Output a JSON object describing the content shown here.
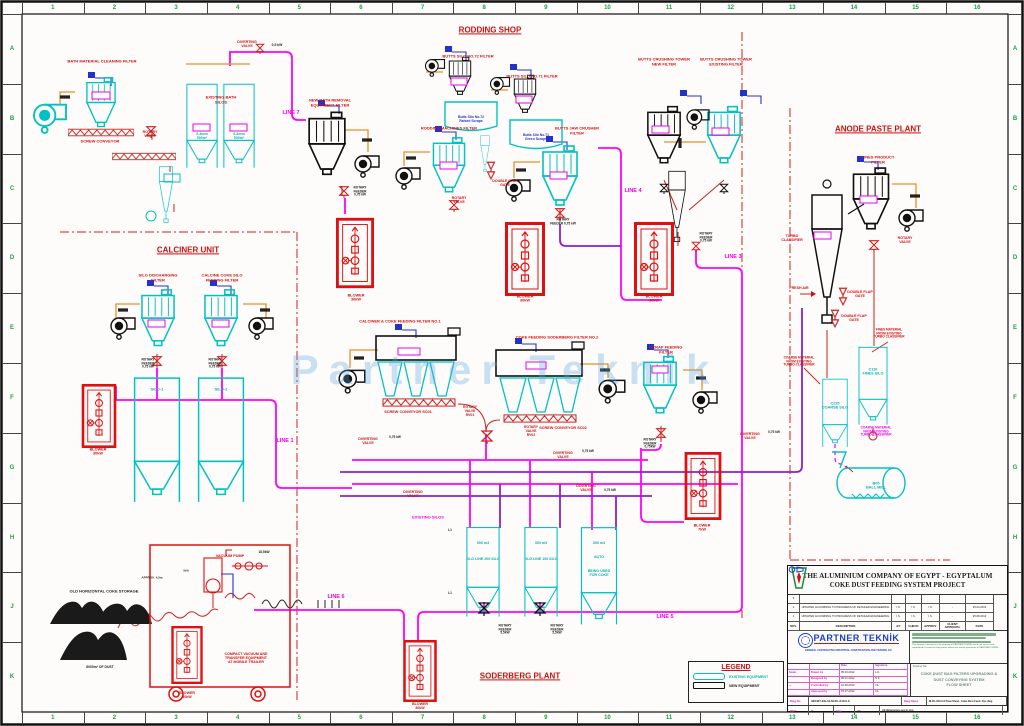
{
  "colors": {
    "red": "#cc1111",
    "magenta": "#ee00ee",
    "purple": "#8822cc",
    "cyan": "#00b2b2",
    "black": "#222222",
    "green": "#18a04a",
    "blue": "#2233cc",
    "existing": "#00c2c2",
    "new": "#111111",
    "pipe_magenta": "#ff00ff"
  },
  "watermark": "Partner Teknik",
  "grid": {
    "cols": [
      "1",
      "2",
      "3",
      "4",
      "5",
      "6",
      "7",
      "8",
      "9",
      "10",
      "11",
      "12",
      "13",
      "14",
      "15",
      "16"
    ],
    "rows": [
      "A",
      "B",
      "C",
      "D",
      "E",
      "F",
      "G",
      "H",
      "J",
      "K"
    ]
  },
  "legend": {
    "title": "LEGEND",
    "items": [
      {
        "label": "EXISTING EQUIPMENT",
        "cls": "existing"
      },
      {
        "label": "NEW EQUIPMENT",
        "cls": "new"
      }
    ]
  },
  "labels": [
    {
      "t": "RODDING SHOP",
      "x": 490,
      "y": 30,
      "c": "red",
      "f": 8,
      "u": 1
    },
    {
      "t": "ANODE PASTE PLANT",
      "x": 878,
      "y": 129,
      "c": "red",
      "f": 8,
      "u": 1
    },
    {
      "t": "CALCINER UNIT",
      "x": 188,
      "y": 250,
      "c": "red",
      "f": 8,
      "u": 1
    },
    {
      "t": "SODERBERG PLANT",
      "x": 520,
      "y": 676,
      "c": "red",
      "f": 8,
      "u": 1
    },
    {
      "t": "BATH MATERIAL CLEANING FILTER",
      "x": 102,
      "y": 62,
      "c": "red",
      "f": 4
    },
    {
      "t": "SCREW CONVEYOR",
      "x": 100,
      "y": 142,
      "c": "red",
      "f": 4
    },
    {
      "t": "ROTARY\nVALVE",
      "x": 150,
      "y": 134,
      "c": "red",
      "f": 3.6
    },
    {
      "t": "EXISTING BATH\nSILOS",
      "x": 221,
      "y": 100,
      "c": "red",
      "f": 4
    },
    {
      "t": "0-4mm\n500m³",
      "x": 202,
      "y": 136,
      "c": "cyan",
      "f": 3.6
    },
    {
      "t": "0-4mm\n500m³",
      "x": 239,
      "y": 136,
      "c": "cyan",
      "f": 3.6
    },
    {
      "t": "DIVERTING\nVALVE",
      "x": 247,
      "y": 44,
      "c": "red",
      "f": 3.6
    },
    {
      "t": "0,5 kW",
      "x": 277,
      "y": 46,
      "c": "black",
      "f": 3.4
    },
    {
      "t": "LINE 7",
      "x": 291,
      "y": 113,
      "c": "magenta",
      "f": 5.5
    },
    {
      "t": "NEW BATH REMOVAL\nEQUIPMENT FILTER",
      "x": 330,
      "y": 103,
      "c": "red",
      "f": 4
    },
    {
      "t": "ROTARY\nFEEDER\n0,75 kW",
      "x": 360,
      "y": 192,
      "c": "black",
      "f": 3.2
    },
    {
      "t": "BLOWER\n30kW",
      "x": 356,
      "y": 298,
      "c": "red",
      "f": 3.8
    },
    {
      "t": "BUTTS SILO NO.72 FILTER",
      "x": 468,
      "y": 57,
      "c": "red",
      "f": 4
    },
    {
      "t": "Butts Silo No.72\nRaised Scraps",
      "x": 471,
      "y": 120,
      "c": "blue",
      "f": 3.4
    },
    {
      "t": "BUTTS SILO NO.71 FILTER",
      "x": 532,
      "y": 77,
      "c": "red",
      "f": 4
    },
    {
      "t": "Butts Silo No.71\nGreen Scraps",
      "x": 536,
      "y": 138,
      "c": "blue",
      "f": 3.4
    },
    {
      "t": "RODDING MACHINES FILTER",
      "x": 449,
      "y": 129,
      "c": "red",
      "f": 4
    },
    {
      "t": "ROTARY\nVALVE",
      "x": 459,
      "y": 200,
      "c": "red",
      "f": 3.6
    },
    {
      "t": "DOUBLE FLAP\nGATE",
      "x": 505,
      "y": 183,
      "c": "red",
      "f": 3.6
    },
    {
      "t": "BUTTS JAW CRUSHER\nFILTER",
      "x": 577,
      "y": 131,
      "c": "red",
      "f": 4
    },
    {
      "t": "ROTARY\nFEEDER 0,75 kW",
      "x": 563,
      "y": 222,
      "c": "black",
      "f": 3.2
    },
    {
      "t": "BLOWER\n30kW",
      "x": 525,
      "y": 299,
      "c": "red",
      "f": 3.8
    },
    {
      "t": "BLOWER\n30kW",
      "x": 654,
      "y": 299,
      "c": "red",
      "f": 3.8
    },
    {
      "t": "BUTTS CRUSHING TOWER\nNEW FILTER",
      "x": 664,
      "y": 62,
      "c": "red",
      "f": 4
    },
    {
      "t": "BUTTS CRUSHING TOWER\nEXISTING FILTER",
      "x": 726,
      "y": 62,
      "c": "red",
      "f": 4
    },
    {
      "t": "ROTARY\nFEEDER\n0,75 kW",
      "x": 706,
      "y": 238,
      "c": "black",
      "f": 3.2
    },
    {
      "t": "LINE 4",
      "x": 633,
      "y": 191,
      "c": "magenta",
      "f": 5.5
    },
    {
      "t": "LINE 3",
      "x": 733,
      "y": 257,
      "c": "magenta",
      "f": 5.5
    },
    {
      "t": "FINES PRODUCT\nFILTER",
      "x": 878,
      "y": 160,
      "c": "red",
      "f": 4
    },
    {
      "t": "ROTARY\nVALVE",
      "x": 905,
      "y": 240,
      "c": "red",
      "f": 3.6
    },
    {
      "t": "TURBO\nCLASSIFIER",
      "x": 792,
      "y": 238,
      "c": "red",
      "f": 3.6
    },
    {
      "t": "FRESH AIR",
      "x": 799,
      "y": 288,
      "c": "red",
      "f": 3.6
    },
    {
      "t": "DOUBLE FLAP\nGATE",
      "x": 860,
      "y": 294,
      "c": "red",
      "f": 3.6
    },
    {
      "t": "DOUBLE FLAP\nGATE",
      "x": 854,
      "y": 318,
      "c": "red",
      "f": 3.6
    },
    {
      "t": "FINES MATERIAL\nFROM EXISTING\nTURBO CLASSIFIER",
      "x": 889,
      "y": 334,
      "c": "red",
      "f": 3.2
    },
    {
      "t": "COARSE MATERIAL\nFROM EXISTING\nTURBO CLASSIFIER",
      "x": 799,
      "y": 362,
      "c": "red",
      "f": 3.2
    },
    {
      "t": "C110\nFINES SILO",
      "x": 873,
      "y": 372,
      "c": "cyan",
      "f": 3.8
    },
    {
      "t": "C225\nCOARSE SILO",
      "x": 835,
      "y": 406,
      "c": "cyan",
      "f": 3.8
    },
    {
      "t": "COARSE MATERIAL\nFROM EXISTING\nTURBO CLASSIFIER",
      "x": 876,
      "y": 432,
      "c": "magenta",
      "f": 3.2
    },
    {
      "t": "B05\nBALL MILL",
      "x": 876,
      "y": 486,
      "c": "cyan",
      "f": 3.8
    },
    {
      "t": "SILO DISCHARGING\nFILTER",
      "x": 158,
      "y": 278,
      "c": "red",
      "f": 4
    },
    {
      "t": "CALCINE COKE SILO\nFEEDING FILTER",
      "x": 222,
      "y": 278,
      "c": "red",
      "f": 4
    },
    {
      "t": "ROTARY\nFEEDER\n0,75 kW",
      "x": 148,
      "y": 364,
      "c": "black",
      "f": 3.2
    },
    {
      "t": "ROTARY\nFEEDER\n0,75 kW",
      "x": 215,
      "y": 364,
      "c": "black",
      "f": 3.2
    },
    {
      "t": "BLOWER\n30kW",
      "x": 98,
      "y": 452,
      "c": "red",
      "f": 3.8
    },
    {
      "t": "SILO-1",
      "x": 157,
      "y": 390,
      "c": "cyan",
      "f": 4
    },
    {
      "t": "SILO-2",
      "x": 221,
      "y": 390,
      "c": "cyan",
      "f": 4
    },
    {
      "t": "LINE 1",
      "x": 285,
      "y": 441,
      "c": "magenta",
      "f": 5.5
    },
    {
      "t": "CALCINER & COKE FEEDING  FILTER NO.1",
      "x": 400,
      "y": 322,
      "c": "red",
      "f": 4
    },
    {
      "t": "COKE FEEDING SODERBERG FILTER NO.2",
      "x": 557,
      "y": 338,
      "c": "red",
      "f": 4
    },
    {
      "t": "SCREW CONVEYOR SC01",
      "x": 408,
      "y": 412,
      "c": "red",
      "f": 3.8
    },
    {
      "t": "ROTARY\nVALVE\nRV01",
      "x": 470,
      "y": 412,
      "c": "red",
      "f": 3.4
    },
    {
      "t": "SCREW CONVEYOR SC02",
      "x": 563,
      "y": 428,
      "c": "red",
      "f": 3.8
    },
    {
      "t": "ROTARY\nVALVE\nRV02",
      "x": 531,
      "y": 432,
      "c": "red",
      "f": 3.4
    },
    {
      "t": "SCRAP FEEDING\nFILTER",
      "x": 666,
      "y": 350,
      "c": "red",
      "f": 4
    },
    {
      "t": "ROTARY\nFEEDER\n0,75kW",
      "x": 650,
      "y": 444,
      "c": "black",
      "f": 3.2
    },
    {
      "t": "BLOWER\n7kW",
      "x": 702,
      "y": 528,
      "c": "red",
      "f": 3.8
    },
    {
      "t": "DIVERTING\nVALVE",
      "x": 368,
      "y": 441,
      "c": "red",
      "f": 3.6
    },
    {
      "t": "0,75 kW",
      "x": 395,
      "y": 438,
      "c": "black",
      "f": 3.2
    },
    {
      "t": "DIVERTING\nVALVE",
      "x": 413,
      "y": 494,
      "c": "red",
      "f": 3.6
    },
    {
      "t": "DIVERTING\nVALVE",
      "x": 563,
      "y": 455,
      "c": "red",
      "f": 3.6
    },
    {
      "t": "0,75 kW",
      "x": 588,
      "y": 452,
      "c": "black",
      "f": 3.2
    },
    {
      "t": "DIVERTING\nVALVE",
      "x": 750,
      "y": 436,
      "c": "red",
      "f": 3.6
    },
    {
      "t": "0,75 kW",
      "x": 774,
      "y": 433,
      "c": "black",
      "f": 3.2
    },
    {
      "t": "DIVERTING\nVALVE",
      "x": 586,
      "y": 488,
      "c": "red",
      "f": 3.6
    },
    {
      "t": "0,75 kW",
      "x": 610,
      "y": 491,
      "c": "black",
      "f": 3.2
    },
    {
      "t": "EXISTING SILOS",
      "x": 428,
      "y": 518,
      "c": "magenta",
      "f": 4
    },
    {
      "t": "L1",
      "x": 450,
      "y": 531,
      "c": "black",
      "f": 3.2
    },
    {
      "t": "L1",
      "x": 450,
      "y": 594,
      "c": "black",
      "f": 3.2
    },
    {
      "t": "500 m3",
      "x": 483,
      "y": 543,
      "c": "cyan",
      "f": 3.6
    },
    {
      "t": "OLD LINE 200 SILO",
      "x": 483,
      "y": 559,
      "c": "cyan",
      "f": 3.6
    },
    {
      "t": "300 m3",
      "x": 541,
      "y": 543,
      "c": "cyan",
      "f": 3.6
    },
    {
      "t": "OLD LINE 100 SILO",
      "x": 541,
      "y": 559,
      "c": "cyan",
      "f": 3.6
    },
    {
      "t": "300 m3",
      "x": 599,
      "y": 543,
      "c": "cyan",
      "f": 3.6
    },
    {
      "t": "AUTO",
      "x": 599,
      "y": 557,
      "c": "cyan",
      "f": 3.6
    },
    {
      "t": "BEING USED\nFOR COKE",
      "x": 599,
      "y": 573,
      "c": "cyan",
      "f": 3.6
    },
    {
      "t": "ROTARY\nFEEDER\n5,5kW",
      "x": 505,
      "y": 630,
      "c": "black",
      "f": 3.2
    },
    {
      "t": "ROTARY\nFEEDER\n5,5kW",
      "x": 557,
      "y": 630,
      "c": "black",
      "f": 3.2
    },
    {
      "t": "LINE 5",
      "x": 665,
      "y": 617,
      "c": "magenta",
      "f": 5.5
    },
    {
      "t": "LINE 6",
      "x": 336,
      "y": 597,
      "c": "magenta",
      "f": 5.5
    },
    {
      "t": "OLD HORIZONTAL  COKE  STORAGE",
      "x": 104,
      "y": 592,
      "c": "black",
      "f": 4
    },
    {
      "t": "6000m³ OF DUST",
      "x": 100,
      "y": 668,
      "c": "black",
      "f": 3.4
    },
    {
      "t": "VACUUM PUMP",
      "x": 230,
      "y": 556,
      "c": "red",
      "f": 3.8
    },
    {
      "t": "18,5kW",
      "x": 264,
      "y": 553,
      "c": "black",
      "f": 3.2
    },
    {
      "t": "APPROX. 4,5m",
      "x": 152,
      "y": 578,
      "c": "black",
      "f": 3
    },
    {
      "t": "5t/h",
      "x": 186,
      "y": 571,
      "c": "black",
      "f": 3
    },
    {
      "t": "COMPACT VACUUM AND\nTRANSFER EQUIPMENT\nAT MOBILE TRAILER",
      "x": 246,
      "y": 658,
      "c": "red",
      "f": 3.6
    },
    {
      "t": "BLOWER\n30kW",
      "x": 187,
      "y": 695,
      "c": "red",
      "f": 3.6
    },
    {
      "t": "BLOWER\n30kW",
      "x": 420,
      "y": 706,
      "c": "red",
      "f": 3.6
    }
  ],
  "title_block": {
    "company_line1": "THE ALUMINIUM COMPANY OF EGYPT - EGYPTALUM",
    "company_line2": "COKE DUST FEEDING SYSTEM PROJECT",
    "rev_grid": [
      [
        "3",
        "",
        "",
        "",
        "",
        "",
        ""
      ],
      [
        "2",
        "UPDATED ACCORDING TO PROGRESS OF DETAILED ENGINEERING",
        "I.S.",
        "I.S.",
        "I.S.",
        "-",
        "25.04.2013"
      ],
      [
        "1",
        "UPDATED ACCORDING TO PROGRESS OF DETAILED ENGINEERING",
        "I.S.",
        "I.S.",
        "I.S.",
        "-",
        "25.08.2012"
      ],
      [
        "REV.",
        "DESCRIPTION",
        "BY",
        "CHECK",
        "APPROV.",
        "CLIENT APPROVAL",
        "DATE"
      ]
    ],
    "firm_name": "PARTNER TEKNİK",
    "firm_sub": "GENERAL CONTRACTING INDUSTRIAL CONSTRUCTION AND TRADING CO.",
    "own_note": "This drawing / document is the property of PARTNER TEKNİK and it can not be used, reproduced or issued to third parties without the written permission of PARTNER TEKNİK.",
    "sign_grid": [
      [
        "",
        "",
        "Date",
        "Signature"
      ],
      [
        "Scale",
        "Drawn by",
        "05.03.2012",
        "L.K."
      ],
      [
        "",
        "Designed by",
        "05.01.2012",
        "N.K."
      ],
      [
        "—",
        "Controlled by",
        "10.05.2012",
        "I.S."
      ],
      [
        "",
        "Approved by",
        "15.07.2012",
        "I.S."
      ]
    ],
    "drawing_title_caption": "Drawing Title",
    "drawing_title": "COKE DUST BAG FILTERS UPGRADING &\nDUST CONVEYING SYSTEM\nFLOW  SHEET",
    "dwg_no_label": "Dwg No",
    "dwg_no": "340407.EG.12.M.00–010.0.3",
    "dwg_name_label": "Dwg Name",
    "dwg_name": "M.00–010.0.3 Flow Sheet_Coke Dust Feed. Sys.dwg",
    "rev_label": "REV",
    "rev_value": "2",
    "size_label": "Size",
    "size_value": "A1",
    "dims_note": "All dimensions are in mm"
  }
}
